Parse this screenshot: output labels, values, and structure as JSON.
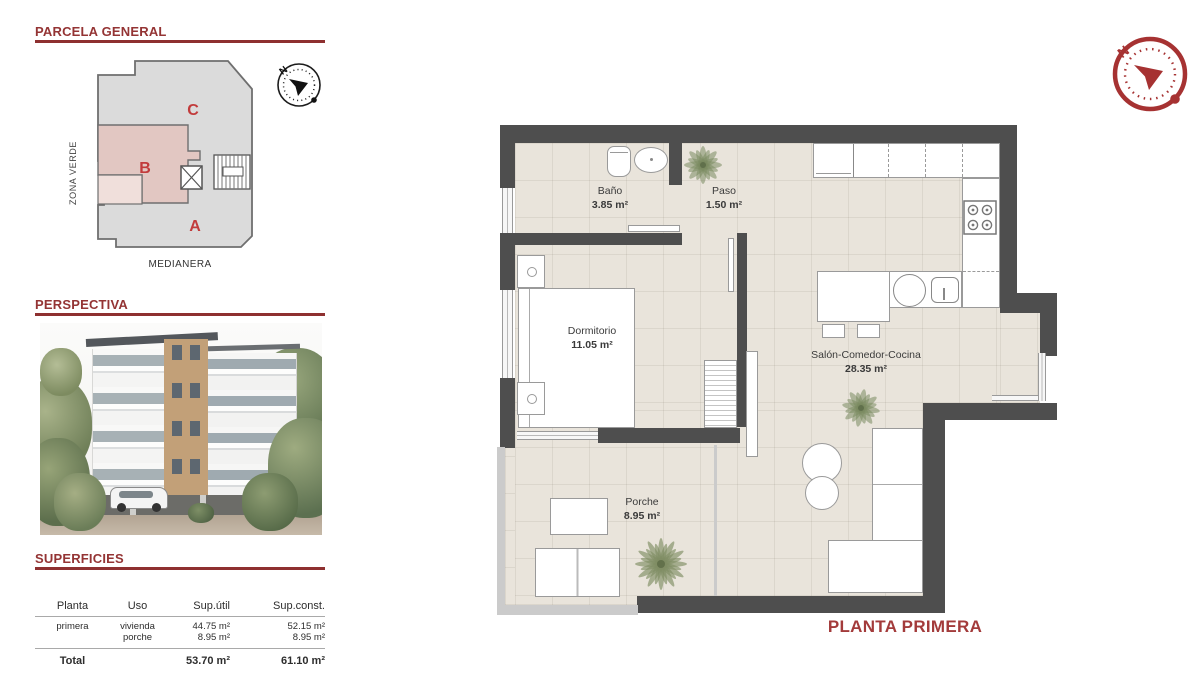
{
  "parcela": {
    "title": "PARCELA GENERAL",
    "zona_verde": "ZONA VERDE",
    "medianera": "MEDIANERA",
    "zones": {
      "a": "A",
      "b": "B",
      "c": "C"
    },
    "compass_n": "N"
  },
  "perspectiva": {
    "title": "PERSPECTIVA"
  },
  "superficies": {
    "title": "SUPERFICIES",
    "headers": {
      "planta": "Planta",
      "uso": "Uso",
      "sup_util": "Sup.útil",
      "sup_const": "Sup.const."
    },
    "row": {
      "planta": "primera",
      "uso_1": "vivienda",
      "uso_2": "porche",
      "sup_util_1": "44.75 m²",
      "sup_util_2": "8.95 m²",
      "sup_const_1": "52.15 m²",
      "sup_const_2": "8.95 m²"
    },
    "total": {
      "label": "Total",
      "sup_util": "53.70 m²",
      "sup_const": "61.10 m²"
    }
  },
  "floor_plan": {
    "title": "PLANTA PRIMERA",
    "compass_n": "N",
    "rooms": {
      "bano": {
        "name": "Baño",
        "area": "3.85 m²"
      },
      "paso": {
        "name": "Paso",
        "area": "1.50 m²"
      },
      "dormitorio": {
        "name": "Dormitorio",
        "area": "11.05 m²"
      },
      "salon": {
        "name": "Salón-Comedor-Cocina",
        "area": "28.35 m²"
      },
      "porche": {
        "name": "Porche",
        "area": "8.95 m²"
      }
    }
  },
  "colors": {
    "accent_red": "#943434",
    "plan_title_red": "#a33b3b",
    "wall_gray": "#4e4e4e",
    "floor_beige": "#e9e4db",
    "zone_b_pink": "#e2c7c2",
    "site_gray": "#dbdbdb"
  }
}
